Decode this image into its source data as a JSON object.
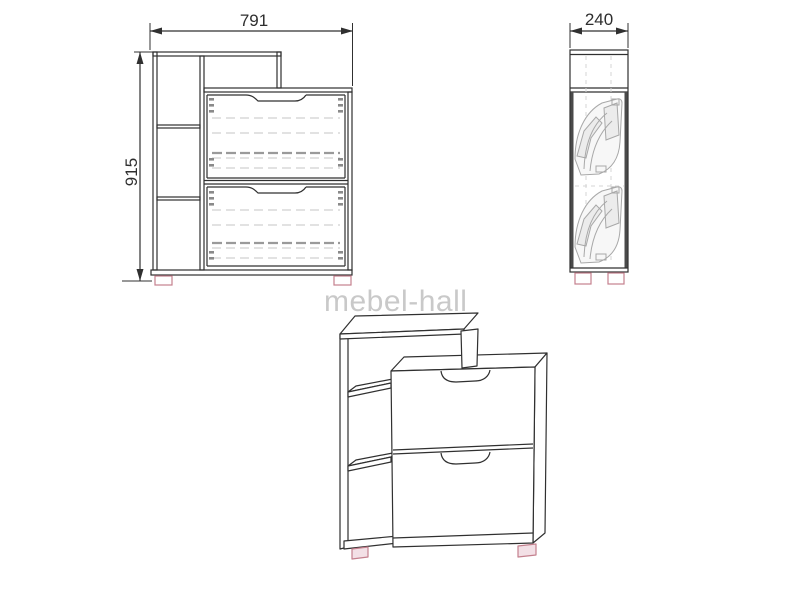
{
  "page": {
    "background": "#ffffff",
    "watermark": {
      "text": "mebel-hall",
      "color": "#c9c9c9"
    },
    "dimensions": {
      "width": "791",
      "height": "915",
      "depth": "240"
    },
    "style": {
      "line_color": "#303030",
      "hidden_line_color": "#c6c6c6",
      "hidden_line_dark": "#9a9a9a",
      "mechanism_color": "#a8a8a8",
      "dark_edge_color": "#4a4a4a",
      "feet_outline": "#c4808e",
      "feet_fill": "#f3e0e6"
    }
  }
}
